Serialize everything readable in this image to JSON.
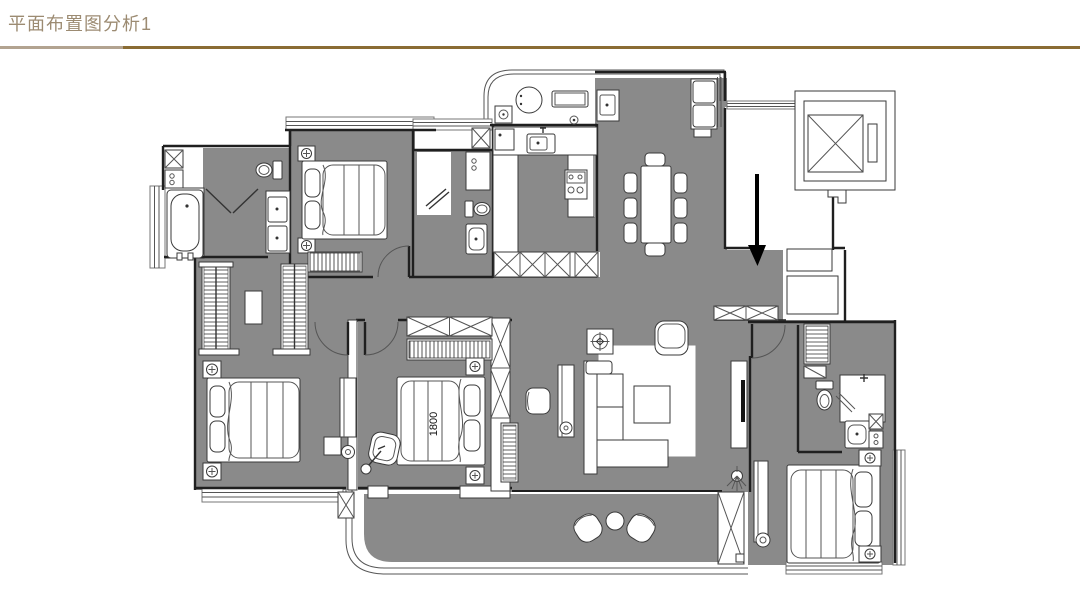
{
  "header": {
    "title": "平面布置图分析1",
    "title_color": "#9c8b72",
    "divider_left_color": "#b2a390",
    "divider_right_color": "#8a6c34"
  },
  "floorplan": {
    "floor_color": "#8a8a8a",
    "wall_color": "#1f1f1f",
    "furniture_color": "#ffffff",
    "annotation_arrow_color": "#000000",
    "bed_dimension_label": "1800",
    "annotations": [
      {
        "name": "entry-direction-arrow",
        "shape": "down-arrow",
        "color": "#000000"
      }
    ]
  }
}
